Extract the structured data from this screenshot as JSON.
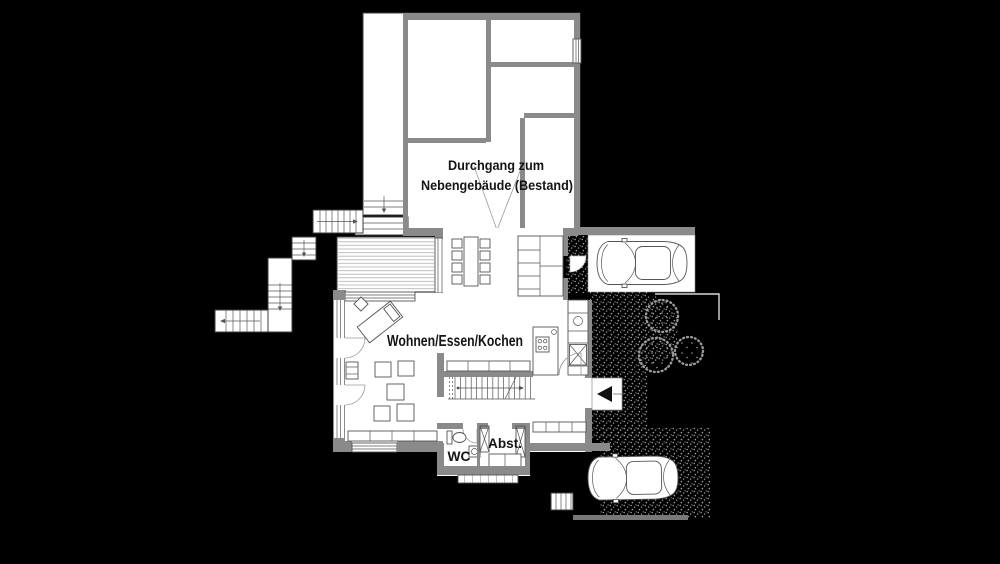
{
  "labels": {
    "passage_line1": "Durchgang zum",
    "passage_line2": "Nebengebäude (Bestand)",
    "living": "Wohnen/Essen/Kochen",
    "wc": "WC",
    "storage": "Abst."
  },
  "colors": {
    "background": "#000000",
    "floor": "#ffffff",
    "wall": "#8a8a8a",
    "wall_dark": "#6e6e6e",
    "outline": "#3c3c3c",
    "line": "#555555",
    "deck_line": "#b8b8b8",
    "stipple": "#9a9a9a",
    "driveway": "#787878",
    "text": "#141414",
    "entrance_marker": "#111111"
  }
}
